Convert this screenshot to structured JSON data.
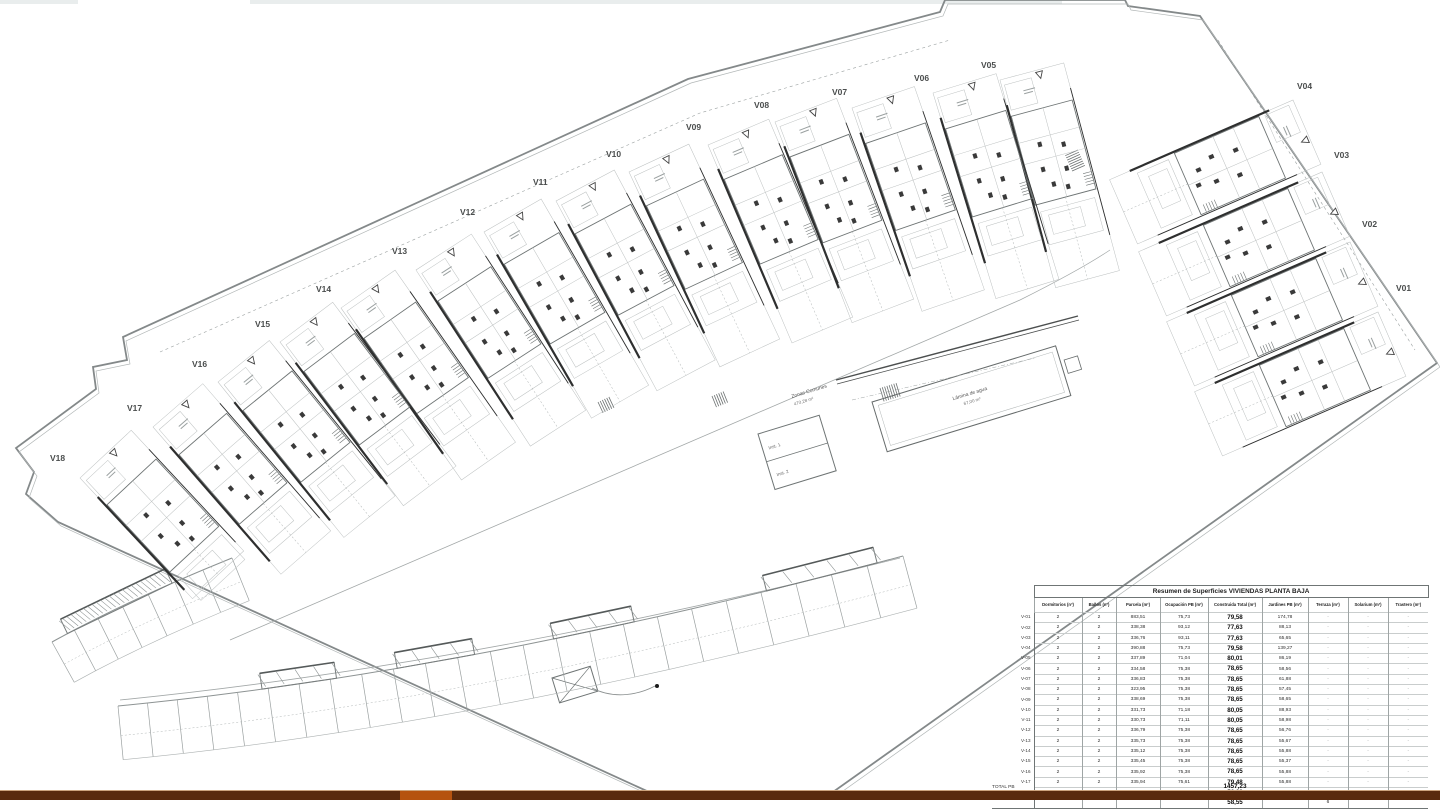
{
  "plan": {
    "units": [
      {
        "label": "V01"
      },
      {
        "label": "V02"
      },
      {
        "label": "V03"
      },
      {
        "label": "V04"
      },
      {
        "label": "V05"
      },
      {
        "label": "V06"
      },
      {
        "label": "V07"
      },
      {
        "label": "V08"
      },
      {
        "label": "V09"
      },
      {
        "label": "V10"
      },
      {
        "label": "V11"
      },
      {
        "label": "V12"
      },
      {
        "label": "V13"
      },
      {
        "label": "V14"
      },
      {
        "label": "V15"
      },
      {
        "label": "V16"
      },
      {
        "label": "V17"
      },
      {
        "label": "V18"
      }
    ],
    "annotations": {
      "zonas_comunes_line1": "Zonas Comunes",
      "zonas_comunes_line2": "470,28 m²",
      "lamina_line1": "Lámina de agua",
      "lamina_line2": "67,00 m²",
      "inst1": "Inst. 1",
      "inst2": "Inst. 2"
    },
    "line_color": "#84898a",
    "wall_color": "#2e2f2f"
  },
  "table": {
    "title": "Resumen de Superficies VIVIENDAS PLANTA BAJA",
    "columns": [
      "",
      "Dormitorios (nº)",
      "Baños (nº)",
      "Parcela (m²)",
      "Ocupación PB (m²)",
      "Construida Total (m²)",
      "Jardines PB (m²)",
      "Terraza (m²)",
      "Solarium (m²)",
      "Trastero (m²)"
    ],
    "rows": [
      {
        "id": "V-01",
        "dorm": "2",
        "ban": "2",
        "parcela": "883,51",
        "ocup": "75,73",
        "constr": "79,58",
        "jard": "174,78",
        "terr": "-",
        "sol": "-",
        "tras": "-"
      },
      {
        "id": "V-02",
        "dorm": "2",
        "ban": "2",
        "parcela": "338,38",
        "ocup": "93,12",
        "constr": "77,63",
        "jard": "88,13",
        "terr": "-",
        "sol": "-",
        "tras": "-"
      },
      {
        "id": "V-03",
        "dorm": "2",
        "ban": "2",
        "parcela": "336,76",
        "ocup": "93,11",
        "constr": "77,63",
        "jard": "65,65",
        "terr": "-",
        "sol": "-",
        "tras": "-"
      },
      {
        "id": "V-04",
        "dorm": "2",
        "ban": "2",
        "parcela": "390,88",
        "ocup": "75,73",
        "constr": "79,58",
        "jard": "139,27",
        "terr": "-",
        "sol": "-",
        "tras": "-"
      },
      {
        "id": "V-05",
        "dorm": "2",
        "ban": "2",
        "parcela": "337,89",
        "ocup": "71,04",
        "constr": "80,01",
        "jard": "86,19",
        "terr": "-",
        "sol": "-",
        "tras": "-"
      },
      {
        "id": "V-06",
        "dorm": "2",
        "ban": "2",
        "parcela": "334,58",
        "ocup": "75,38",
        "constr": "78,65",
        "jard": "58,56",
        "terr": "-",
        "sol": "-",
        "tras": "-"
      },
      {
        "id": "V-07",
        "dorm": "2",
        "ban": "2",
        "parcela": "336,83",
        "ocup": "75,38",
        "constr": "78,65",
        "jard": "61,88",
        "terr": "-",
        "sol": "-",
        "tras": "-"
      },
      {
        "id": "V-08",
        "dorm": "2",
        "ban": "2",
        "parcela": "323,95",
        "ocup": "75,38",
        "constr": "78,65",
        "jard": "57,45",
        "terr": "-",
        "sol": "-",
        "tras": "-"
      },
      {
        "id": "V-09",
        "dorm": "2",
        "ban": "2",
        "parcela": "338,69",
        "ocup": "75,38",
        "constr": "78,65",
        "jard": "58,65",
        "terr": "-",
        "sol": "-",
        "tras": "-"
      },
      {
        "id": "V-10",
        "dorm": "2",
        "ban": "2",
        "parcela": "331,73",
        "ocup": "71,18",
        "constr": "80,05",
        "jard": "88,93",
        "terr": "-",
        "sol": "-",
        "tras": "-"
      },
      {
        "id": "V-11",
        "dorm": "2",
        "ban": "2",
        "parcela": "330,73",
        "ocup": "71,11",
        "constr": "80,05",
        "jard": "58,98",
        "terr": "-",
        "sol": "-",
        "tras": "-"
      },
      {
        "id": "V-12",
        "dorm": "2",
        "ban": "2",
        "parcela": "336,79",
        "ocup": "75,38",
        "constr": "78,65",
        "jard": "56,76",
        "terr": "-",
        "sol": "-",
        "tras": "-"
      },
      {
        "id": "V-13",
        "dorm": "2",
        "ban": "2",
        "parcela": "335,73",
        "ocup": "75,38",
        "constr": "78,65",
        "jard": "55,67",
        "terr": "-",
        "sol": "-",
        "tras": "-"
      },
      {
        "id": "V-14",
        "dorm": "2",
        "ban": "2",
        "parcela": "335,12",
        "ocup": "75,38",
        "constr": "78,65",
        "jard": "55,88",
        "terr": "-",
        "sol": "-",
        "tras": "-"
      },
      {
        "id": "V-15",
        "dorm": "2",
        "ban": "2",
        "parcela": "335,45",
        "ocup": "75,38",
        "constr": "78,65",
        "jard": "55,37",
        "terr": "-",
        "sol": "-",
        "tras": "-"
      },
      {
        "id": "V-16",
        "dorm": "2",
        "ban": "2",
        "parcela": "335,92",
        "ocup": "75,38",
        "constr": "78,65",
        "jard": "55,88",
        "terr": "-",
        "sol": "-",
        "tras": "-"
      },
      {
        "id": "V-17",
        "dorm": "2",
        "ban": "2",
        "parcela": "335,94",
        "ocup": "75,61",
        "constr": "79,48",
        "jard": "55,88",
        "terr": "-",
        "sol": "-",
        "tras": "-"
      },
      {
        "id": "V-18",
        "dorm": "3",
        "ban": "2",
        "parcela": "398,28",
        "ocup": "51,30",
        "constr": [
          "56,22",
          "58,55"
        ],
        "jard": "146,85",
        "terr": [
          "5,1",
          "6"
        ],
        "sol": "16,6",
        "tras": "0"
      }
    ],
    "total_label": "TOTAL PB",
    "total_value": "1457,23"
  },
  "footer": {
    "bar_color": "#5a2b0d",
    "accent_color": "#b5530f"
  }
}
